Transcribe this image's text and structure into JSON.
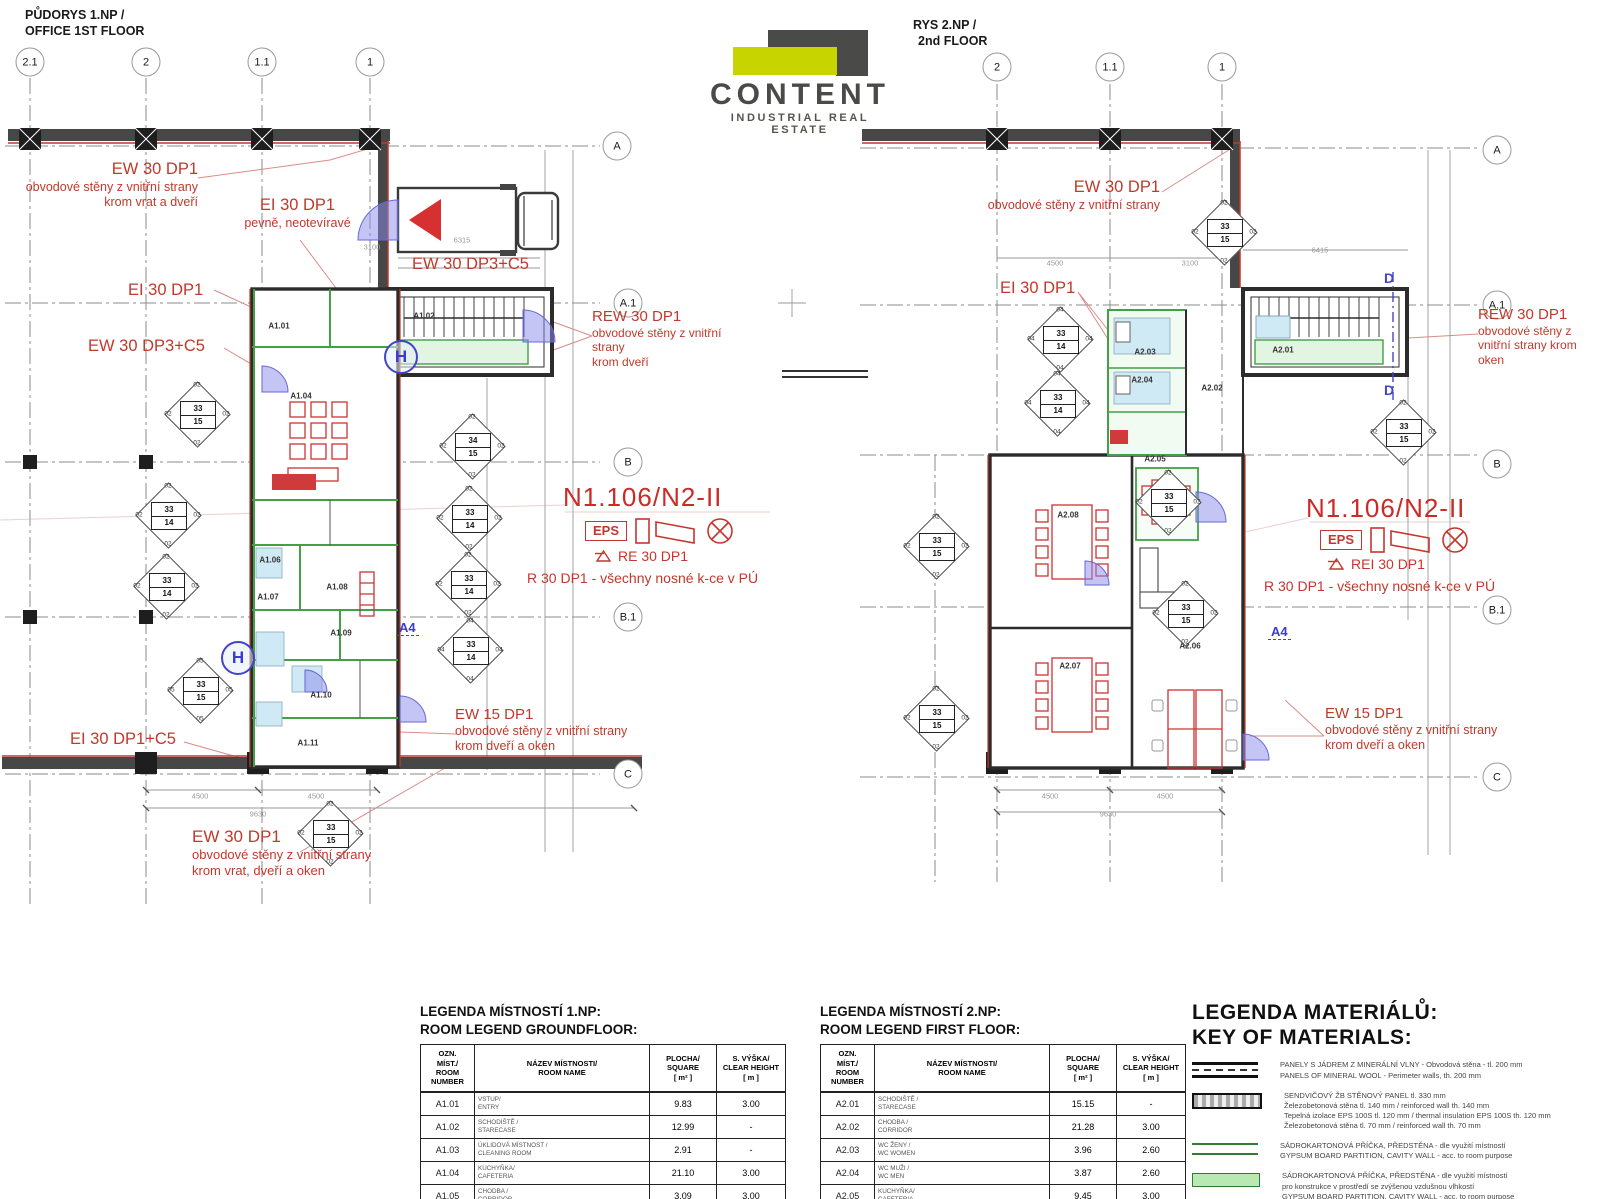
{
  "titles": {
    "left_line1": "PŮDORYS 1.NP /",
    "left_line2": "OFFICE 1ST FLOOR",
    "right_line1": "RYS 2.NP /",
    "right_line2": "2nd FLOOR"
  },
  "logo": {
    "name": "CONTENT",
    "subtitle": "INDUSTRIAL REAL ESTATE",
    "accent": "#c8d400",
    "dark": "#4a4a48"
  },
  "plan1": {
    "grid_top": [
      {
        "label": "2.1",
        "x": 30,
        "y": 62
      },
      {
        "label": "2",
        "x": 146,
        "y": 62
      },
      {
        "label": "1.1",
        "x": 262,
        "y": 62
      },
      {
        "label": "1",
        "x": 370,
        "y": 62
      }
    ],
    "grid_side": [
      {
        "label": "A",
        "x": 617,
        "y": 146
      },
      {
        "label": "A.1",
        "x": 628,
        "y": 303
      },
      {
        "label": "B",
        "x": 628,
        "y": 462
      },
      {
        "label": "B.1",
        "x": 628,
        "y": 617
      },
      {
        "label": "C",
        "x": 628,
        "y": 774
      }
    ],
    "rooms": [
      {
        "id": "A1.01",
        "x": 279,
        "y": 326
      },
      {
        "id": "A1.02",
        "x": 424,
        "y": 316
      },
      {
        "id": "A1.04",
        "x": 301,
        "y": 396
      },
      {
        "id": "A1.06",
        "x": 270,
        "y": 560
      },
      {
        "id": "A1.07",
        "x": 268,
        "y": 597
      },
      {
        "id": "A1.08",
        "x": 337,
        "y": 587
      },
      {
        "id": "A1.09",
        "x": 341,
        "y": 633
      },
      {
        "id": "A1.10",
        "x": 321,
        "y": 695
      },
      {
        "id": "A1.11",
        "x": 308,
        "y": 743
      }
    ],
    "diamonds": [
      {
        "x": 197,
        "y": 414,
        "a": "33",
        "b": "15",
        "c": "02"
      },
      {
        "x": 168,
        "y": 515,
        "a": "33",
        "b": "14",
        "c": "02"
      },
      {
        "x": 166,
        "y": 586,
        "a": "33",
        "b": "14",
        "c": "02"
      },
      {
        "x": 200,
        "y": 690,
        "a": "33",
        "b": "15",
        "c": "05"
      },
      {
        "x": 472,
        "y": 446,
        "a": "34",
        "b": "15",
        "c": "02"
      },
      {
        "x": 469,
        "y": 518,
        "a": "33",
        "b": "14",
        "c": "02"
      },
      {
        "x": 468,
        "y": 584,
        "a": "33",
        "b": "14",
        "c": "02"
      },
      {
        "x": 470,
        "y": 650,
        "a": "33",
        "b": "14",
        "c": "04"
      },
      {
        "x": 330,
        "y": 833,
        "a": "33",
        "b": "15",
        "c": "02"
      }
    ],
    "dims": [
      {
        "t": "3100",
        "x": 372,
        "y": 247
      },
      {
        "t": "6315",
        "x": 462,
        "y": 240
      },
      {
        "t": "4500",
        "x": 200,
        "y": 796
      },
      {
        "t": "4500",
        "x": 316,
        "y": 796
      },
      {
        "t": "9630",
        "x": 258,
        "y": 814
      }
    ],
    "ann": {
      "ew30_top": {
        "head": "EW 30 DP1",
        "l1": "obvodové stěny z vnitřní strany",
        "l2": "krom vrat a dveří"
      },
      "ei30_pevne": {
        "head": "EI 30 DP1",
        "l1": "pevně, neotevíravé"
      },
      "ei30": "EI 30 DP1",
      "ew30dp3": "EW 30 DP3+C5",
      "ew30dp3_b": "EW 30 DP3+C5",
      "rew30": {
        "head": "REW 30 DP1",
        "l1": "obvodové stěny z vnitřní strany",
        "l2": "krom dveří"
      },
      "zone": "N1.106/N2-II",
      "eps": "EPS",
      "re30": "RE 30 DP1",
      "r30": "R 30 DP1 - všechny nosné k-ce v PÚ",
      "ei30c5": "EI 30 DP1+C5",
      "ew30_bottom": {
        "head": "EW 30 DP1",
        "l1": "obvodové stěny z vnitřní strany",
        "l2": "krom vrat, dveří a oken"
      },
      "ew15": {
        "head": "EW 15 DP1",
        "l1": "obvodové stěny z vnitřní strany",
        "l2": "krom dveří a oken"
      }
    },
    "section_label": "A4",
    "h_symbol": "H"
  },
  "plan2": {
    "grid_top": [
      {
        "label": "2",
        "x": 997,
        "y": 67
      },
      {
        "label": "1.1",
        "x": 1110,
        "y": 67
      },
      {
        "label": "1",
        "x": 1222,
        "y": 67
      }
    ],
    "grid_side": [
      {
        "label": "A",
        "x": 1497,
        "y": 150
      },
      {
        "label": "A.1",
        "x": 1497,
        "y": 305
      },
      {
        "label": "B",
        "x": 1497,
        "y": 464
      },
      {
        "label": "B.1",
        "x": 1497,
        "y": 610
      },
      {
        "label": "C",
        "x": 1497,
        "y": 777
      }
    ],
    "rooms": [
      {
        "id": "A2.01",
        "x": 1283,
        "y": 350
      },
      {
        "id": "A2.02",
        "x": 1212,
        "y": 388
      },
      {
        "id": "A2.03",
        "x": 1145,
        "y": 352
      },
      {
        "id": "A2.04",
        "x": 1142,
        "y": 380
      },
      {
        "id": "A2.05",
        "x": 1155,
        "y": 459
      },
      {
        "id": "A2.06",
        "x": 1190,
        "y": 646
      },
      {
        "id": "A2.07",
        "x": 1070,
        "y": 666
      },
      {
        "id": "A2.08",
        "x": 1068,
        "y": 515
      }
    ],
    "diamonds": [
      {
        "x": 1224,
        "y": 232,
        "a": "33",
        "b": "15",
        "c": "02"
      },
      {
        "x": 1060,
        "y": 339,
        "a": "33",
        "b": "14",
        "c": "04"
      },
      {
        "x": 1057,
        "y": 403,
        "a": "33",
        "b": "14",
        "c": "04"
      },
      {
        "x": 936,
        "y": 546,
        "a": "33",
        "b": "15",
        "c": "02"
      },
      {
        "x": 936,
        "y": 718,
        "a": "33",
        "b": "15",
        "c": "02"
      },
      {
        "x": 1168,
        "y": 502,
        "a": "33",
        "b": "15",
        "c": "02"
      },
      {
        "x": 1185,
        "y": 613,
        "a": "33",
        "b": "15",
        "c": "02"
      },
      {
        "x": 1403,
        "y": 432,
        "a": "33",
        "b": "15",
        "c": "02"
      }
    ],
    "dims": [
      {
        "t": "4500",
        "x": 1055,
        "y": 263
      },
      {
        "t": "3100",
        "x": 1190,
        "y": 263
      },
      {
        "t": "4500",
        "x": 1050,
        "y": 796
      },
      {
        "t": "4500",
        "x": 1165,
        "y": 796
      },
      {
        "t": "9630",
        "x": 1108,
        "y": 814
      },
      {
        "t": "6415",
        "x": 1320,
        "y": 250
      }
    ],
    "ann": {
      "ew30_top": {
        "head": "EW 30 DP1",
        "l1": "obvodové stěny z vnitřní strany"
      },
      "ei30": "EI 30 DP1",
      "rew30": {
        "head": "REW 30 DP1",
        "l1": "obvodové stěny z",
        "l2": "vnitřní strany krom",
        "l3": "oken"
      },
      "zone": "N1.106/N2-II",
      "eps": "EPS",
      "rei30": "REI 30 DP1",
      "r30": "R 30 DP1 - všechny nosné k-ce v PÚ",
      "ew15": {
        "head": "EW 15 DP1",
        "l1": "obvodové stěny z vnitřní strany",
        "l2": "krom dveří a oken"
      }
    },
    "section_label": "A4",
    "d_label": "D"
  },
  "legend1": {
    "title1": "LEGENDA MÍSTNOSTÍ 1.NP:",
    "title2": "ROOM LEGEND GROUNDFLOOR:",
    "headers": {
      "h1": "OZN.\nMÍST./\nROOM\nNUMBER",
      "h2": "NÁZEV MÍSTNOSTI/\nROOM NAME",
      "h3": "PLOCHA/\nSQUARE\n[ m² ]",
      "h4": "S. VÝŠKA/\nCLEAR HEIGHT\n[ m ]"
    },
    "rows": [
      {
        "id": "A1.01",
        "cz": "VSTUP/",
        "en": "ENTRY",
        "area": "9.83",
        "h": "3.00"
      },
      {
        "id": "A1.02",
        "cz": "SCHODIŠTĚ /",
        "en": "STARECASE",
        "area": "12.99",
        "h": "-"
      },
      {
        "id": "A1.03",
        "cz": "ÚKLIDOVÁ MÍSTNOST /",
        "en": "CLEANING ROOM",
        "area": "2.91",
        "h": "-"
      },
      {
        "id": "A1.04",
        "cz": "KUCHYŇKA/",
        "en": "CAFETERIA",
        "area": "21.10",
        "h": "3.00"
      },
      {
        "id": "A1.05",
        "cz": "CHODBA /",
        "en": "CORRIDOR",
        "area": "3.09",
        "h": "3.00"
      },
      {
        "id": "A1.06",
        "cz": "ŠATNA MUŽI /",
        "en": "LOCKER ROOM MEN",
        "area": "4.80",
        "h": "3.00"
      }
    ]
  },
  "legend2": {
    "title1": "LEGENDA MÍSTNOSTÍ 2.NP:",
    "title2": "ROOM LEGEND FIRST FLOOR:",
    "headers": {
      "h1": "OZN.\nMÍST./\nROOM\nNUMBER",
      "h2": "NÁZEV MÍSTNOSTI/\nROOM NAME",
      "h3": "PLOCHA/\nSQUARE\n[ m² ]",
      "h4": "S. VÝŠKA/\nCLEAR HEIGHT\n[ m ]"
    },
    "rows": [
      {
        "id": "A2.01",
        "cz": "SCHODIŠTĚ /",
        "en": "STARECASE",
        "area": "15.15",
        "h": "-"
      },
      {
        "id": "A2.02",
        "cz": "CHODBA /",
        "en": "CORRIDOR",
        "area": "21.28",
        "h": "3.00"
      },
      {
        "id": "A2.03",
        "cz": "WC ŽENY /",
        "en": "WC WOMEN",
        "area": "3.96",
        "h": "2.60"
      },
      {
        "id": "A2.04",
        "cz": "WC MUŽI /",
        "en": "WC MEN",
        "area": "3.87",
        "h": "2.60"
      },
      {
        "id": "A2.05",
        "cz": "KUCHYŇKA/",
        "en": "CAFETERIA",
        "area": "9.45",
        "h": "3.00"
      },
      {
        "id": "A2.06",
        "cz": "KANCELÁŘ /",
        "en": "OFFICE AREA",
        "area": "40.83",
        "h": "3.00"
      }
    ]
  },
  "materials": {
    "title1": "LEGENDA MATERIÁLŮ:",
    "title2": "KEY OF MATERIALS:",
    "items": [
      {
        "sym": "mineral",
        "lines": [
          "PANELY S JÁDREM Z MINERÁLNÍ VLNY - Obvodová stěna - tl. 200 mm",
          "PANELS OF MINERAL WOOL - Perimeter walls, th. 200 mm"
        ]
      },
      {
        "sym": "sandwich",
        "lines": [
          "SENDVIČOVÝ ŽB STĚNOVÝ PANEL tl. 330 mm",
          "Železobetonová stěna tl. 140 mm / reinforced wall th. 140 mm",
          "Tepelná izolace EPS 100S tl. 120 mm / thermal insulation EPS 100S th. 120 mm",
          "Železobetonová stěna tl. 70 mm / reinforced wall th. 70 mm"
        ]
      },
      {
        "sym": "gypsum",
        "lines": [
          "SÁDROKARTONOVÁ PŘÍČKA, PŘEDSTĚNA - dle využití místností",
          "GYPSUM BOARD PARTITION, CAVITY WALL - acc. to room purpose"
        ]
      },
      {
        "sym": "gypsum_humid",
        "lines": [
          "SÁDROKARTONOVÁ PŘÍČKA, PŘEDSTĚNA - dle využití místností",
          "pro konstrukce v prostředí se zvýšenou vzdušnou vlhkostí",
          "GYPSUM BOARD PARTITION, CAVITY WALL - acc. to room purpose",
          "for structures with high humidity"
        ]
      },
      {
        "sym": "gypsum_fire",
        "lines": [
          "SÁDROKARTONOVÁ PŘÍČKA, PŘEDSTĚNA - s požární ochranou"
        ]
      }
    ]
  }
}
